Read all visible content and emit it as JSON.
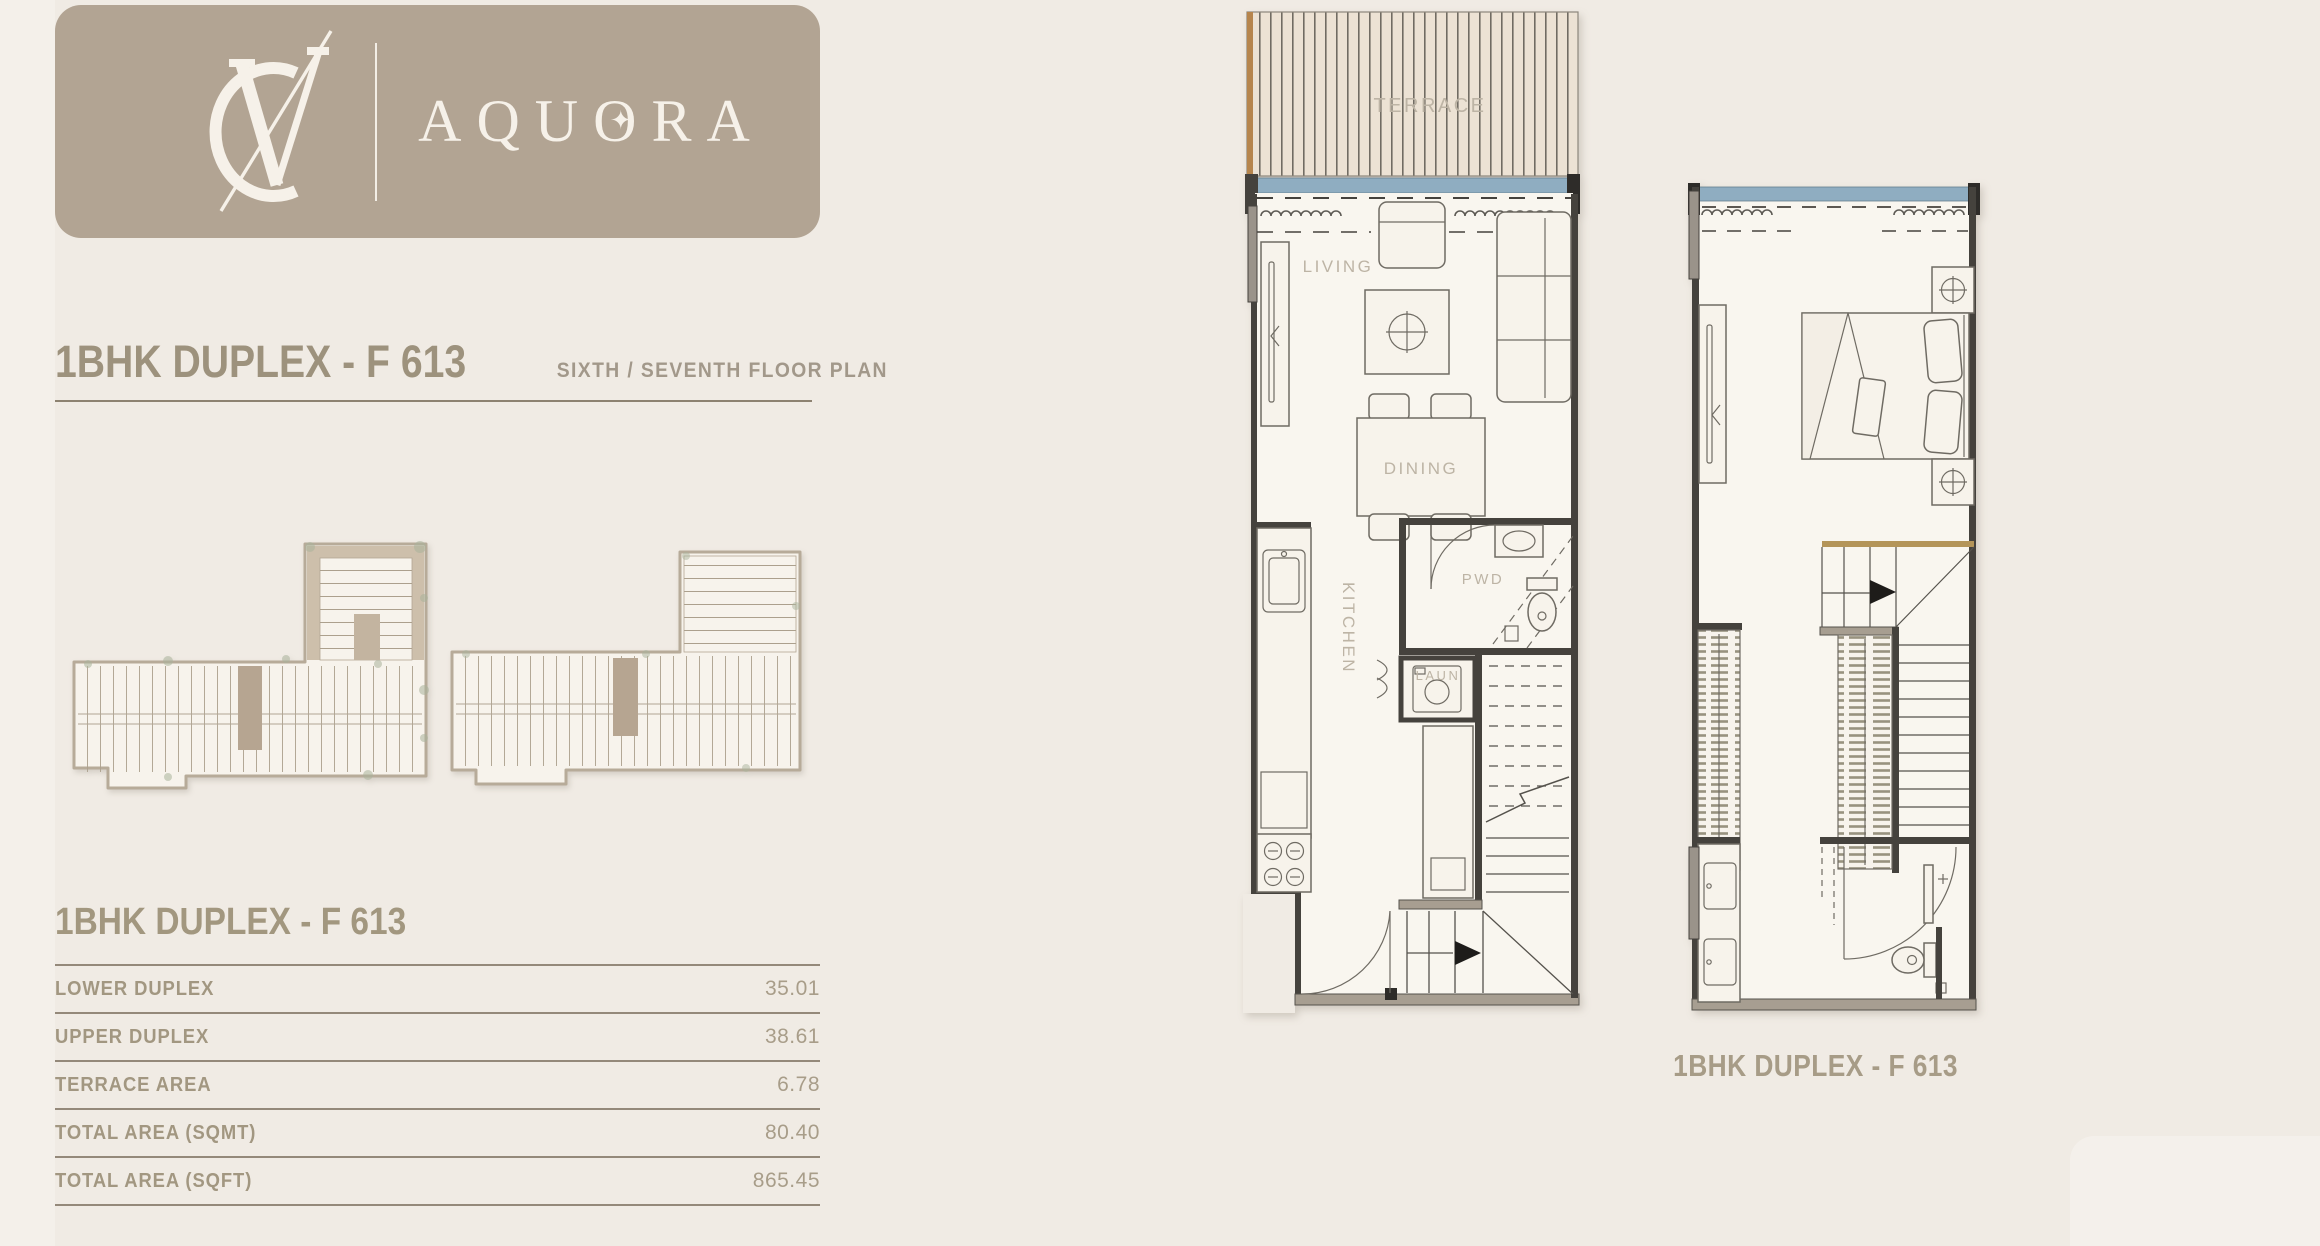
{
  "brand": {
    "monogram": "VC",
    "name_left": "AQU",
    "name_o": "O",
    "name_right": "RA",
    "star": "✦"
  },
  "header": {
    "title": "1BHK DUPLEX - F 613",
    "subtitle": "SIXTH / SEVENTH  FLOOR PLAN"
  },
  "area_table": {
    "title": "1BHK DUPLEX - F 613",
    "rows": [
      {
        "label": "LOWER DUPLEX",
        "value": "35.01"
      },
      {
        "label": "UPPER DUPLEX",
        "value": "38.61"
      },
      {
        "label": "TERRACE AREA",
        "value": "6.78"
      },
      {
        "label": "TOTAL AREA (SQMT)",
        "value": "80.40"
      },
      {
        "label": "TOTAL AREA (SQFT)",
        "value": "865.45"
      }
    ]
  },
  "plans": {
    "lower": {
      "terrace": "TERRACE",
      "living": "LIVING",
      "dining": "DINING",
      "kitchen": "KITCHEN",
      "pwd": "PWD",
      "laundry": "LAUN"
    },
    "upper": {
      "caption": "1BHK DUPLEX - F 613"
    }
  },
  "colors": {
    "background": "#f0ebe4",
    "brand_card": "#b2a493",
    "heading_text": "#9d927d",
    "table_text": "#a29781",
    "rule": "#94897a",
    "window_blue": "#8fadc1",
    "terrace_fill": "#ece2d4",
    "terrace_edge": "#b6854d",
    "wall_dark": "#45423d",
    "plan_floor": "#f9f6ef",
    "keyplan_highlight": "#b6a591",
    "stair_landing": "#b49559"
  }
}
